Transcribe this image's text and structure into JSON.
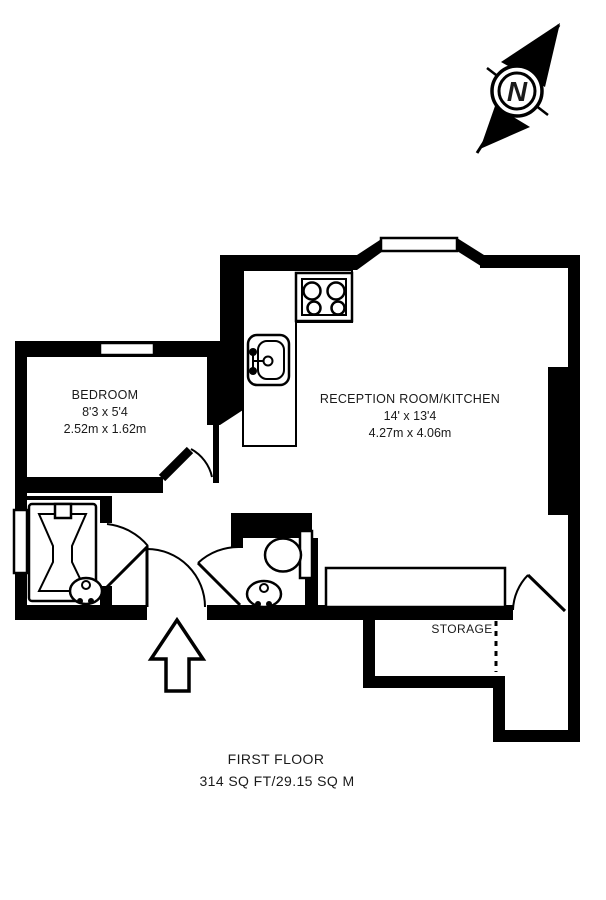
{
  "title": "First floor plan",
  "colors": {
    "line": "#000000",
    "background": "#ffffff"
  },
  "compass": {
    "label": "N"
  },
  "rooms": {
    "bedroom": {
      "name": "BEDROOM",
      "dims_imperial": "8'3 x 5'4",
      "dims_metric": "2.52m x 1.62m"
    },
    "reception": {
      "name": "RECEPTION ROOM/KITCHEN",
      "dims_imperial": "14' x 13'4",
      "dims_metric": "4.27m x 4.06m"
    },
    "storage": {
      "name": "STORAGE"
    }
  },
  "fixtures": [
    "bathtub",
    "wash-basin",
    "toilet",
    "kitchen-sink",
    "stove-hob",
    "worktop",
    "unit"
  ],
  "footer": {
    "floor_label": "FIRST FLOOR",
    "area_label": "314 SQ FT/29.15 SQ M"
  }
}
